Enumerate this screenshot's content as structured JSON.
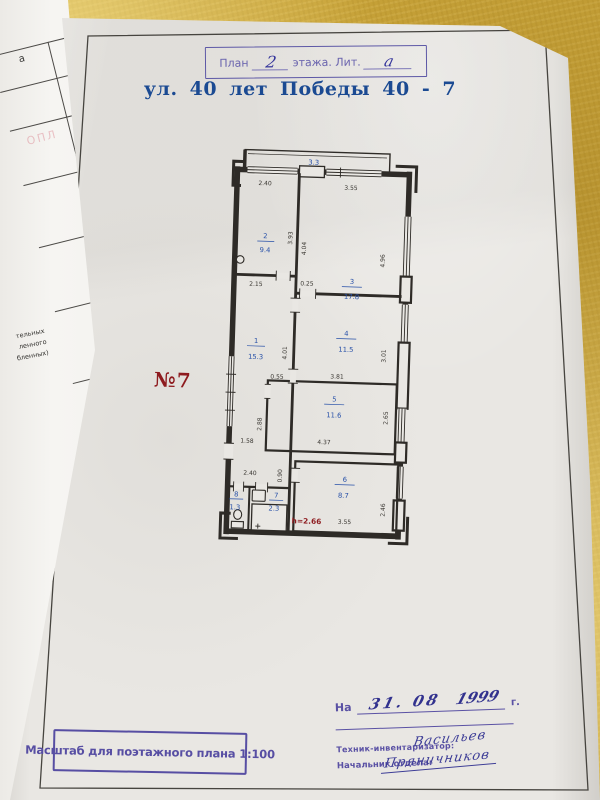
{
  "header": {
    "plan_stamp": {
      "label_prefix": "План",
      "floor_value": "2",
      "label_middle": "этажа. Лит.",
      "liter_value": "а"
    },
    "address": "ул. 40 лет Победы 40 - 7"
  },
  "plan": {
    "apartment_label": "№7",
    "height_note": "h=2.66",
    "rooms": {
      "balcony": {
        "area": "3.3"
      },
      "r1": {
        "num": "1",
        "area": "15.3"
      },
      "r2": {
        "num": "2",
        "area": "9.4"
      },
      "r3": {
        "num": "3",
        "area": "17.8"
      },
      "r4": {
        "num": "4",
        "area": "11.5"
      },
      "r5": {
        "num": "5",
        "area": "11.6"
      },
      "r6": {
        "num": "6",
        "area": "8.7"
      },
      "r7": {
        "num": "7",
        "area": "2.3"
      },
      "r8": {
        "num": "8",
        "area": "1.3"
      }
    },
    "dims": {
      "d240_top": "2.40",
      "d355_top": "3.55",
      "d393": "3.93",
      "d404": "4.04",
      "d496": "4.96",
      "d215": "2.15",
      "d025": "0.25",
      "d401": "4.01",
      "d301": "3.01",
      "d055": "0.55",
      "d381": "3.81",
      "d288": "2.88",
      "d158": "1.58",
      "d265": "2.65",
      "d437": "4.37",
      "d240_hall": "2.40",
      "d090": "0.90",
      "d355_bottom": "3.55",
      "d246": "2.46"
    }
  },
  "footer": {
    "scale_stamp": "Масштаб для поэтажного плана 1:100",
    "date_stamp": {
      "prefix": "На",
      "day_month": "31. 08",
      "year": "1999",
      "suffix": "г."
    },
    "technician": {
      "label": "Техник-инвентаризатор:",
      "signature": "Васильев"
    },
    "department_head": {
      "label": "Начальник отдела:",
      "signature": "Пряничников"
    }
  },
  "underlying_page": {
    "fragment_top": "а",
    "faint_stamp": "ОПЛ",
    "fragments": [
      "тельных",
      "ленного",
      "бленных)"
    ]
  }
}
